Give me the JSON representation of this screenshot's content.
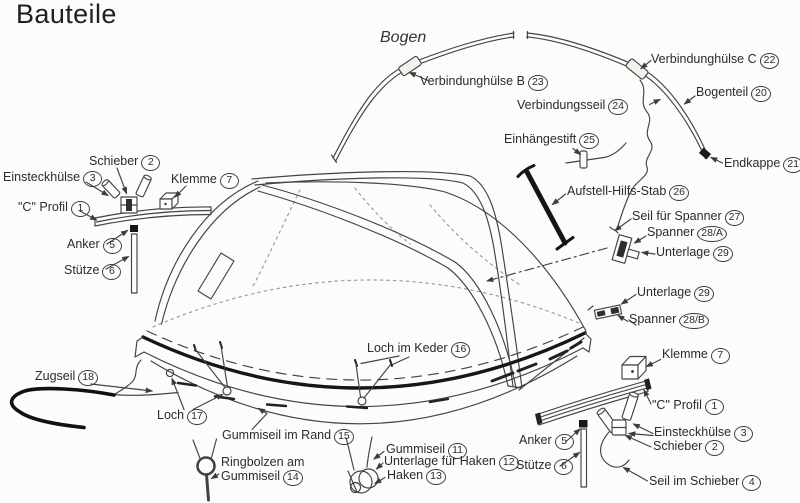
{
  "title": "Bauteile",
  "colors": {
    "background": "#fcfcfb",
    "ink": "#434343",
    "heavy": "#161616",
    "faint": "#9a9a9a",
    "label_text": "#2b2b2b"
  },
  "diagram": {
    "labels": [
      {
        "text": "Schieber",
        "num": "2",
        "x": 89,
        "y": 154
      },
      {
        "text": "Einsteckhülse",
        "num": "3",
        "x": 3,
        "y": 170
      },
      {
        "text": "Klemme",
        "num": "7",
        "x": 171,
        "y": 172
      },
      {
        "text": "\"C\" Profil",
        "num": "1",
        "x": 18,
        "y": 200
      },
      {
        "text": "Anker",
        "num": "5",
        "x": 67,
        "y": 237
      },
      {
        "text": "Stütze",
        "num": "6",
        "x": 64,
        "y": 263
      },
      {
        "text": "Bogen",
        "num": null,
        "x": 380,
        "y": 31,
        "italic": true
      },
      {
        "text": "Verbindunghülse B",
        "num": "23",
        "x": 420,
        "y": 74
      },
      {
        "text": "Verbindunghülse C",
        "num": "22",
        "x": 651,
        "y": 52
      },
      {
        "text": "Bogenteil",
        "num": "20",
        "x": 696,
        "y": 85
      },
      {
        "text": "Verbindungsseil",
        "num": "24",
        "x": 517,
        "y": 98
      },
      {
        "text": "Einhängestift",
        "num": "25",
        "x": 504,
        "y": 132
      },
      {
        "text": "Endkappe",
        "num": "21",
        "x": 724,
        "y": 156
      },
      {
        "text": "Aufstell-Hilfs-Stab",
        "num": "26",
        "x": 567,
        "y": 184
      },
      {
        "text": "Seil für Spanner",
        "num": "27",
        "x": 632,
        "y": 209
      },
      {
        "text": "Spanner",
        "num": "28/A",
        "x": 647,
        "y": 225
      },
      {
        "text": "Unterlage",
        "num": "29",
        "x": 656,
        "y": 245
      },
      {
        "text": "Unterlage",
        "num": "29",
        "x": 637,
        "y": 285
      },
      {
        "text": "Spanner",
        "num": "28/B",
        "x": 629,
        "y": 312
      },
      {
        "text": "Klemme",
        "num": "7",
        "x": 662,
        "y": 347
      },
      {
        "text": "\"C\" Profil",
        "num": "1",
        "x": 652,
        "y": 398
      },
      {
        "text": "Einsteckhülse",
        "num": "3",
        "x": 654,
        "y": 425
      },
      {
        "text": "Schieber",
        "num": "2",
        "x": 653,
        "y": 439
      },
      {
        "text": "Seil im Schieber",
        "num": "4",
        "x": 649,
        "y": 474
      },
      {
        "text": "Anker",
        "num": "5",
        "x": 519,
        "y": 433
      },
      {
        "text": "Stütze",
        "num": "6",
        "x": 516,
        "y": 458
      },
      {
        "text": "Zugseil",
        "num": "18",
        "x": 35,
        "y": 369
      },
      {
        "text": "Loch",
        "num": "17",
        "x": 157,
        "y": 408
      },
      {
        "text": "Gummiseil im Rand",
        "num": "15",
        "x": 222,
        "y": 428
      },
      {
        "text": "Ringbolzen am Gummiseil",
        "num": "14",
        "x": 221,
        "y": 455,
        "w": 102
      },
      {
        "text": "Gummiseil",
        "num": "11",
        "x": 386,
        "y": 442
      },
      {
        "text": "Unterlage für Haken",
        "num": "12",
        "x": 384,
        "y": 454
      },
      {
        "text": "Haken",
        "num": "13",
        "x": 387,
        "y": 468
      },
      {
        "text": "Loch im Keder",
        "num": "16",
        "x": 367,
        "y": 341
      }
    ]
  }
}
